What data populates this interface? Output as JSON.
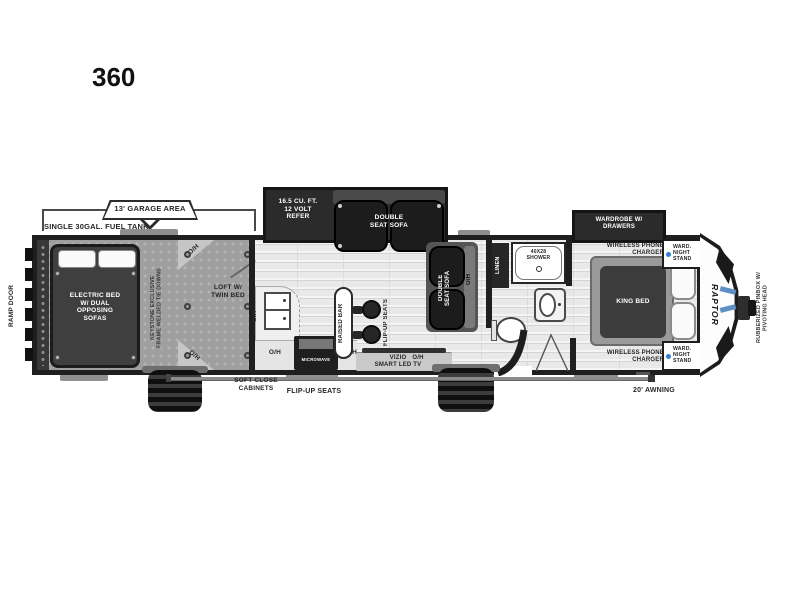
{
  "title": "360",
  "labels": {
    "garage_area": "13' GARAGE AREA",
    "fuel_tank": "SINGLE 30GAL. FUEL TANK",
    "ramp_door": "RAMP DOOR",
    "electric_bed": "ELECTRIC BED\nW/ DUAL\nOPPOSING\nSOFAS",
    "keystone": "KEYSTONE EXCLUSIVE\nFRAME WELDED TIE DOWNS",
    "loft": "LOFT W/\nTWIN BED",
    "oh": "O/H",
    "refer": "16.5 CU. FT.\n12 VOLT\nREFER",
    "double_seat_sofa": "DOUBLE\nSEAT SOFA",
    "raised_bar": "RAISED BAR",
    "flip_up_seats": "FLIP-UP SEATS",
    "soft_close": "SOFT CLOSE\nCABINETS",
    "microwave": "MICROWAVE",
    "tv": "VIZIO\nSMART LED TV",
    "linen": "LINEN",
    "shower": "40X28\nSHOWER",
    "wardrobe": "WARDROBE W/\nDRAWERS",
    "wireless": "WIRELESS PHONE\nCHARGER",
    "nightstand": "WARD.\nNIGHT\nSTAND",
    "king_bed": "KING BED",
    "logo": "RAPTOR",
    "pinbox": "RUBBERIZED PINBOX W/\nPIVOTING HEAD",
    "awning": "20' AWNING"
  },
  "colors": {
    "charger_dot": "#2f7fd4",
    "wall": "#1f1f1f"
  }
}
